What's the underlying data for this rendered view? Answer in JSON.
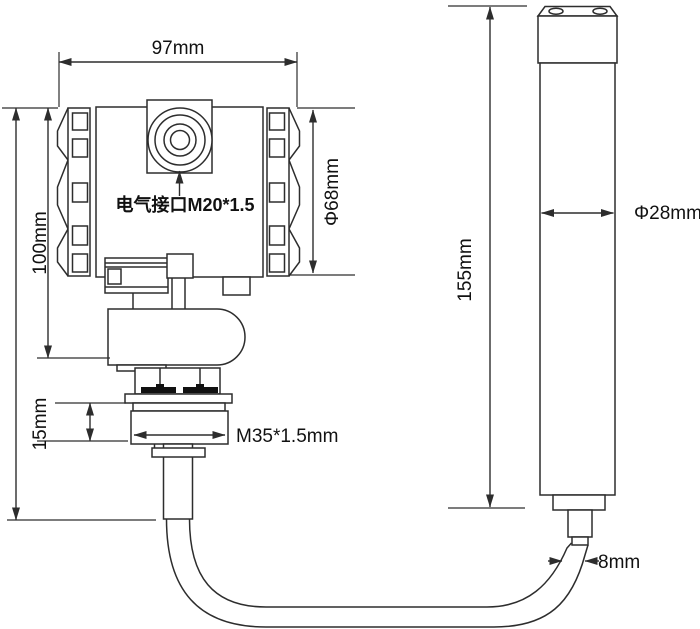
{
  "diagram": {
    "background_color": "#ffffff",
    "line_color": "#2d2d2d",
    "text_color": "#111111",
    "transmitter": {
      "overall_width": "97mm",
      "body_height": "100mm",
      "cap_diameter": "Φ68mm",
      "electrical_port": "电气接口M20*1.5",
      "process_thread": "M35*1.5mm",
      "thread_section_height": "15mm"
    },
    "probe": {
      "length": "155mm",
      "diameter": "Φ28mm",
      "cable_diameter": "8mm"
    }
  }
}
